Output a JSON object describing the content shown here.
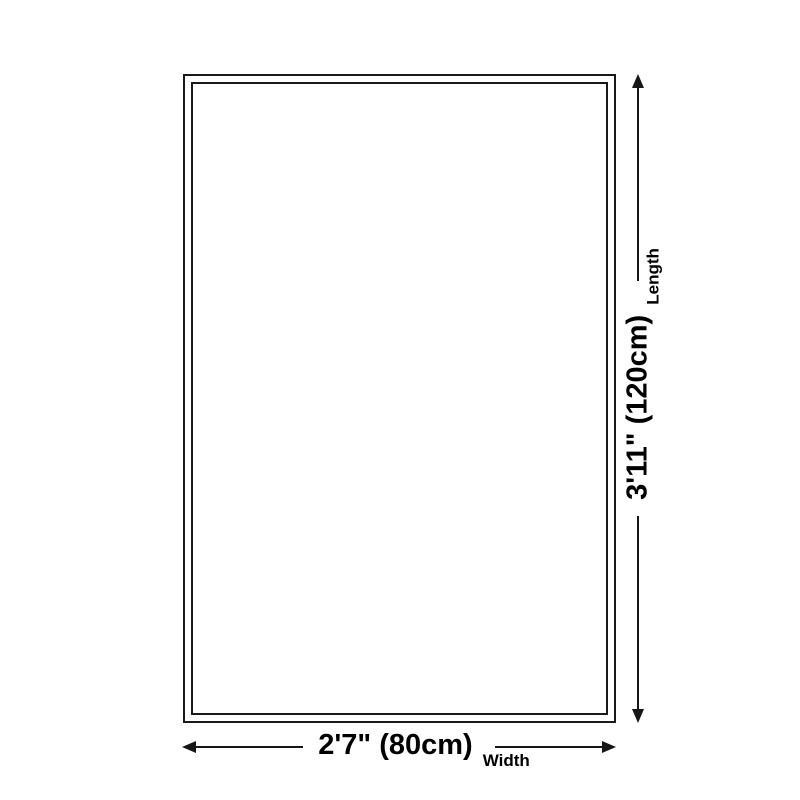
{
  "diagram": {
    "background": "#ffffff",
    "line_color": "#1a1a1a",
    "length": {
      "value": "3'11\" (120cm)",
      "label": "Length"
    },
    "width": {
      "value": "2'7\" (80cm)",
      "label": "Width"
    }
  }
}
